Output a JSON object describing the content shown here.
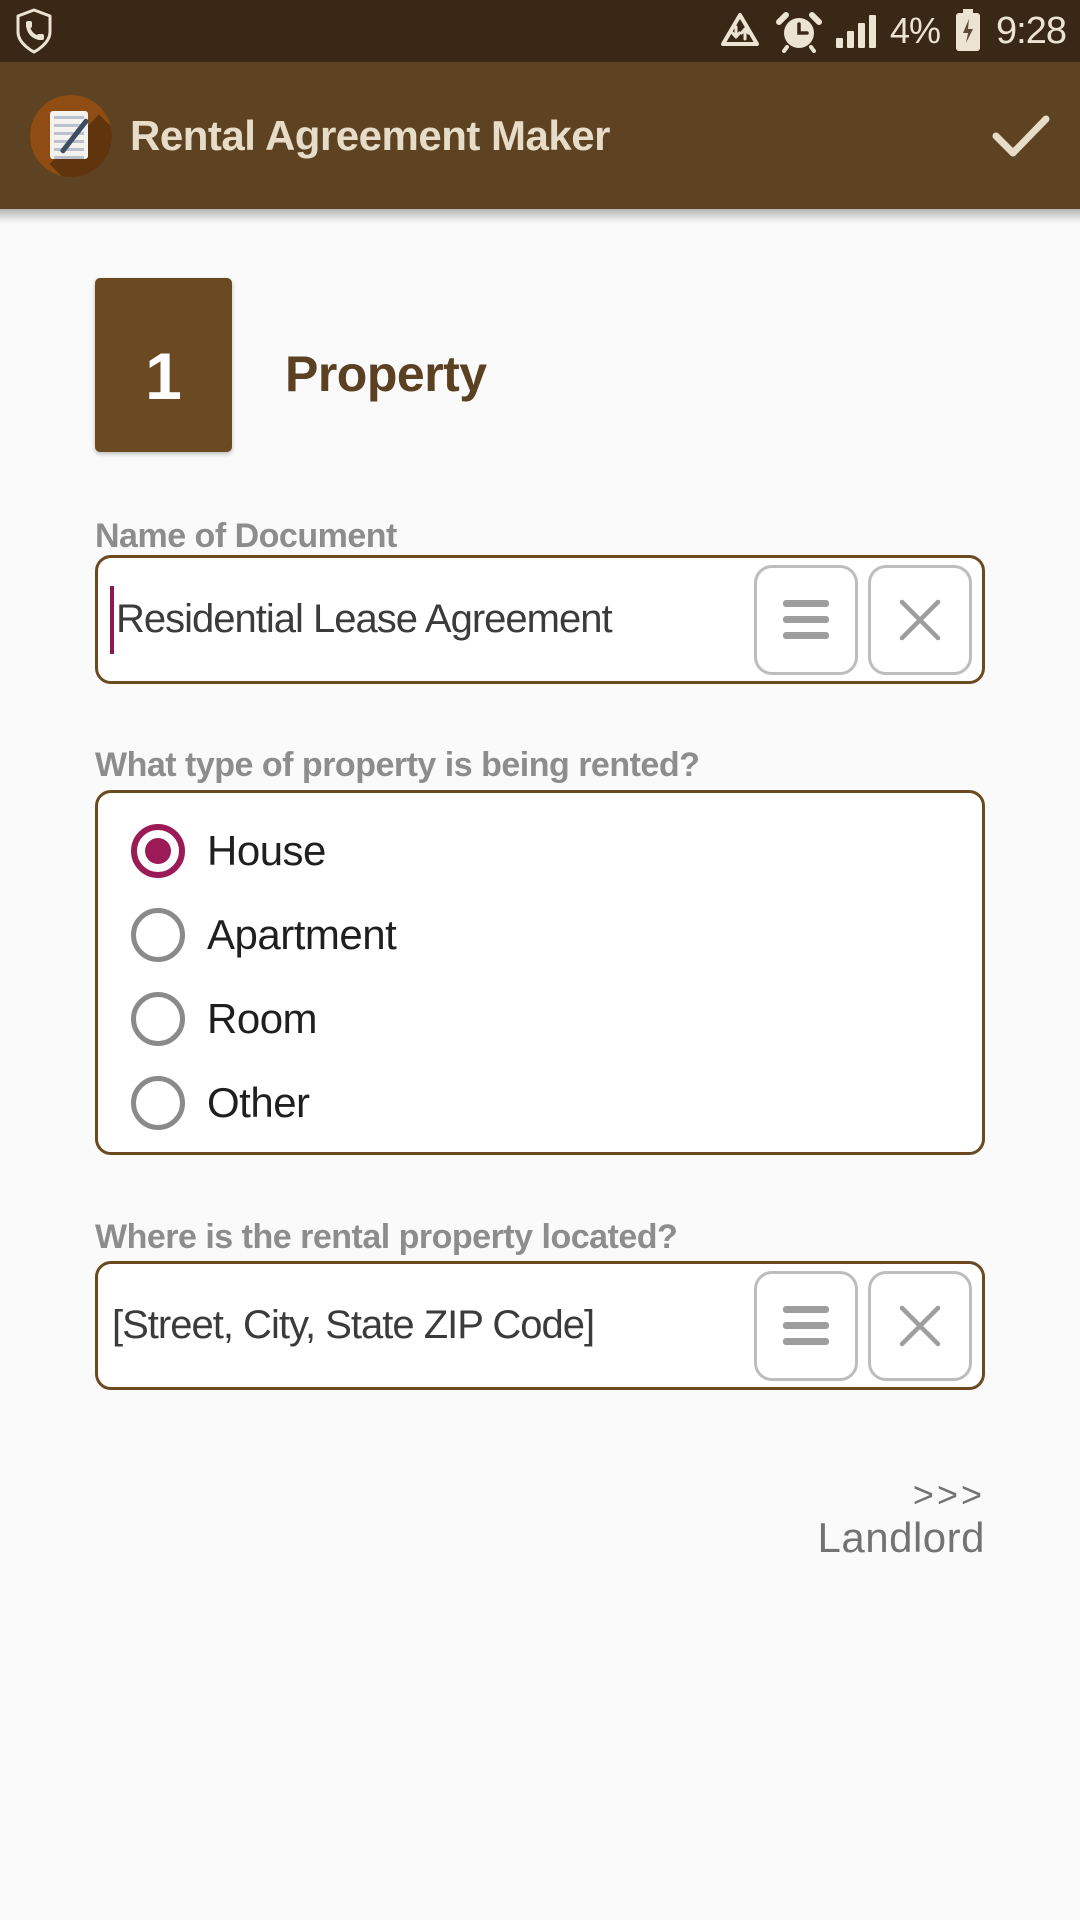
{
  "colors": {
    "status_bar_bg": "#3a2817",
    "app_bar_bg": "#5e4323",
    "accent_brown": "#6b4a21",
    "heading_brown": "#5c4022",
    "radio_selected": "#9c1b56",
    "cursor": "#8c1a4f",
    "background": "#fafafa"
  },
  "status_bar": {
    "time": "9:28",
    "battery_percent": "4%",
    "icons": [
      "shield-phone",
      "data-saver",
      "alarm-clock",
      "signal-bars",
      "battery-charging"
    ]
  },
  "app_bar": {
    "title": "Rental Agreement Maker",
    "icons": [
      "app-logo",
      "confirm-check"
    ]
  },
  "step": {
    "number": "1",
    "title": "Property"
  },
  "document_name": {
    "label": "Name of Document",
    "value": "Residential Lease Agreement"
  },
  "property_type": {
    "label": "What type of property is being rented?",
    "options": [
      {
        "label": "House",
        "selected": true
      },
      {
        "label": "Apartment",
        "selected": false
      },
      {
        "label": "Room",
        "selected": false
      },
      {
        "label": "Other",
        "selected": false
      }
    ]
  },
  "location": {
    "label": "Where is the rental property located?",
    "value": "[Street, City, State ZIP Code]"
  },
  "footer_nav": {
    "arrows": ">>>",
    "label": "Landlord"
  }
}
